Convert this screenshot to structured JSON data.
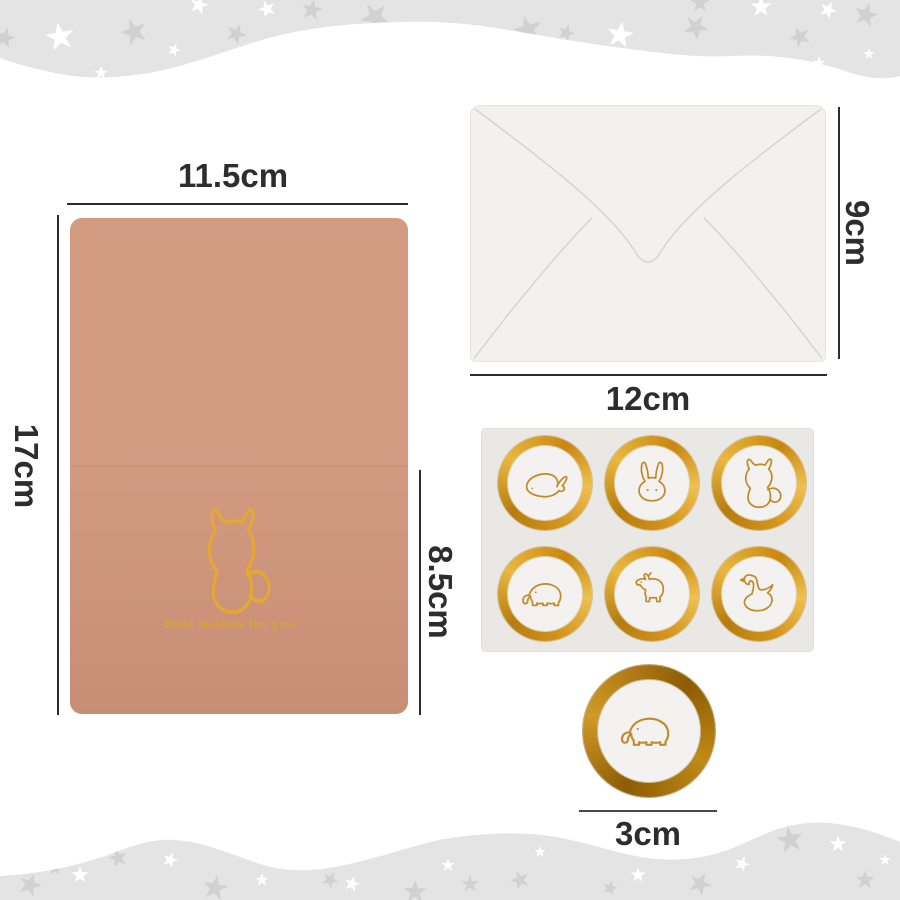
{
  "scene": {
    "kind": "product-dimension-infographic"
  },
  "colors": {
    "band": "#e5e4e4",
    "star-gray": "#d2d1d1",
    "star-white": "#ffffff",
    "card-top": "#d29b82",
    "card-bottom": "#c88e75",
    "card-fold": "#b98067",
    "gold-foil": "#e6a72e",
    "gold-text": "#d9a13c",
    "ring-light": "#eec04e",
    "ring-mid": "#d3941b",
    "ring-dark": "#b67c0e",
    "seal-dark": "#8d5c04",
    "seal-mid": "#c08a16",
    "animal-gold": "#c08b28",
    "envelope": "#f2f1ee",
    "envelope-line": "#d6d4d0",
    "sheet": "#e9e8e5",
    "sticker-inner": "#f3f2f0",
    "dim": "#2d2d2d"
  },
  "card": {
    "width_label": "11.5cm",
    "height_label": "17cm",
    "half_height_label": "8.5cm",
    "message": "Best wishes for you",
    "motif": "cat"
  },
  "envelope": {
    "width_label": "12cm",
    "height_label": "9cm"
  },
  "sticker_sheet": {
    "animals": [
      "whale",
      "rabbit",
      "cat",
      "elephant",
      "horse",
      "swan"
    ]
  },
  "single_sticker": {
    "diameter_label": "3cm",
    "animal": "elephant"
  }
}
